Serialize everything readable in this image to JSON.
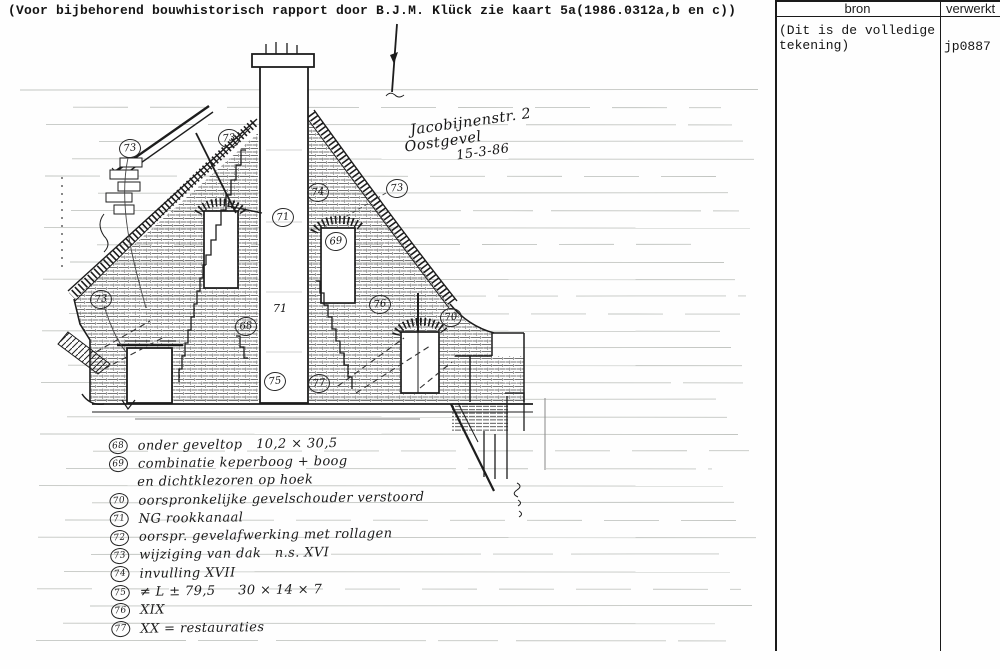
{
  "page": {
    "top_note": "(Voor bijbehorend bouwhistorisch rapport door B.J.M. Klück zie kaart 5a(1986.0312a,b en c))"
  },
  "table": {
    "columns": [
      {
        "label": "bron"
      },
      {
        "label": "verwerkt"
      }
    ],
    "rows": [
      {
        "bron": "(Dit is de volledige tekening)",
        "verwerkt": "jp0887"
      }
    ]
  },
  "drawing": {
    "title_lines": [
      "Jacobijnenstr. 2",
      "Oostgevel",
      "15-3-86"
    ],
    "callouts": [
      {
        "label": "73",
        "x": 129,
        "y": 148
      },
      {
        "label": "73",
        "x": 228,
        "y": 138
      },
      {
        "label": "74",
        "x": 317,
        "y": 192
      },
      {
        "label": "73",
        "x": 396,
        "y": 188
      },
      {
        "label": "71",
        "x": 282,
        "y": 217
      },
      {
        "label": "69",
        "x": 335,
        "y": 241
      },
      {
        "label": "73",
        "x": 100,
        "y": 299
      },
      {
        "label": "68",
        "x": 245,
        "y": 326
      },
      {
        "label": "76",
        "x": 379,
        "y": 304
      },
      {
        "label": "70",
        "x": 450,
        "y": 317
      },
      {
        "label": "75",
        "x": 274,
        "y": 381
      },
      {
        "label": "77",
        "x": 318,
        "y": 383
      },
      {
        "label": "71",
        "x": 279,
        "y": 309,
        "plain": true
      }
    ]
  },
  "legend": {
    "items": [
      {
        "num": "68",
        "lines": [
          "onder geveltop   10,2 × 30,5"
        ]
      },
      {
        "num": "69",
        "lines": [
          "combinatie keperboog + boog",
          "en dichtklezoren op hoek"
        ]
      },
      {
        "num": "70",
        "lines": [
          "oorspronkelijke gevelschouder verstoord"
        ]
      },
      {
        "num": "71",
        "lines": [
          "NG rookkanaal"
        ]
      },
      {
        "num": "72",
        "lines": [
          "oorspr. gevelafwerking met rollagen"
        ]
      },
      {
        "num": "73",
        "lines": [
          "wijziging van dak   n.s. XVI"
        ]
      },
      {
        "num": "74",
        "lines": [
          "invulling XVII"
        ]
      },
      {
        "num": "75",
        "lines": [
          "≠ L ± 79,5     30 × 14 × 7"
        ]
      },
      {
        "num": "76",
        "lines": [
          "XIX"
        ]
      },
      {
        "num": "77",
        "lines": [
          "XX = restauraties"
        ]
      }
    ]
  }
}
